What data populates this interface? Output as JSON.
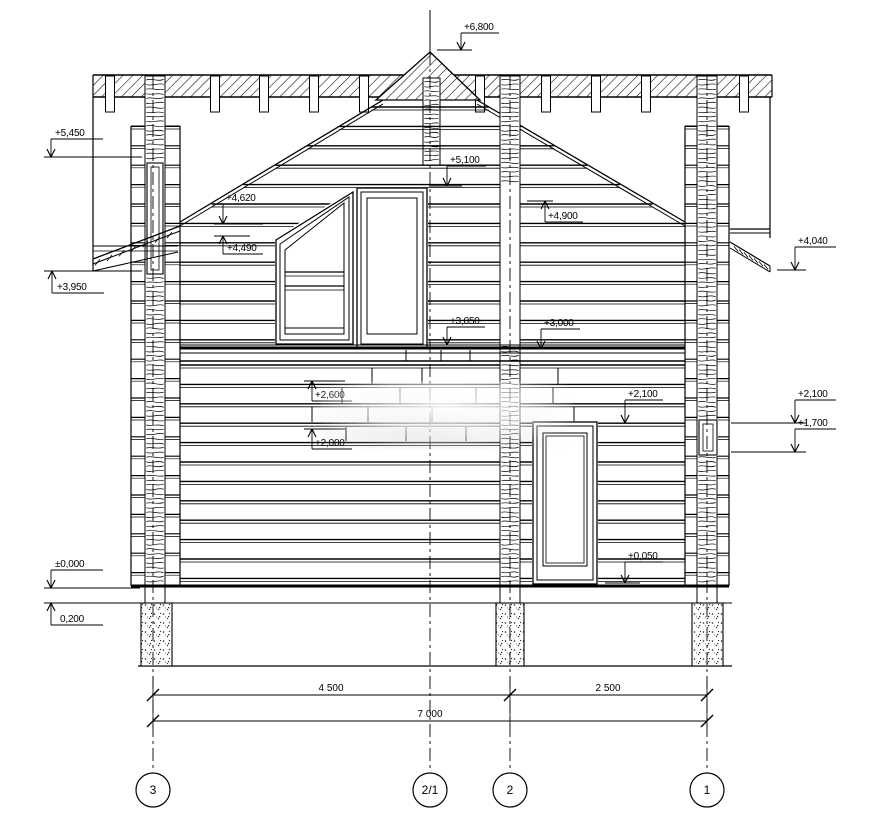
{
  "drawing": {
    "elevations": {
      "ridge": "+6,800",
      "left_wall_top": "+5,450",
      "gable_left": "+5,100",
      "gable_right": "+4,900",
      "window_head": "+4,620",
      "window_slope_base": "+4,490",
      "right_eaves": "+4,040",
      "left_eaves": "+3,950",
      "floor2_left": "+3,050",
      "floor2_right": "+3,000",
      "wall_upper": "+2,600",
      "door_head": "+2,100",
      "right_upper": "+2,100",
      "wall_lower": "+2,000",
      "right_lower": "+1,700",
      "ground_zero": "±0,000",
      "plinth": "0,200",
      "threshold": "+0,050"
    },
    "dimensions": {
      "left_span": "4 500",
      "right_span": "2 500",
      "total": "7 000"
    },
    "axes": {
      "a3": "3",
      "a21": "2/1",
      "a2": "2",
      "a1": "1"
    }
  }
}
